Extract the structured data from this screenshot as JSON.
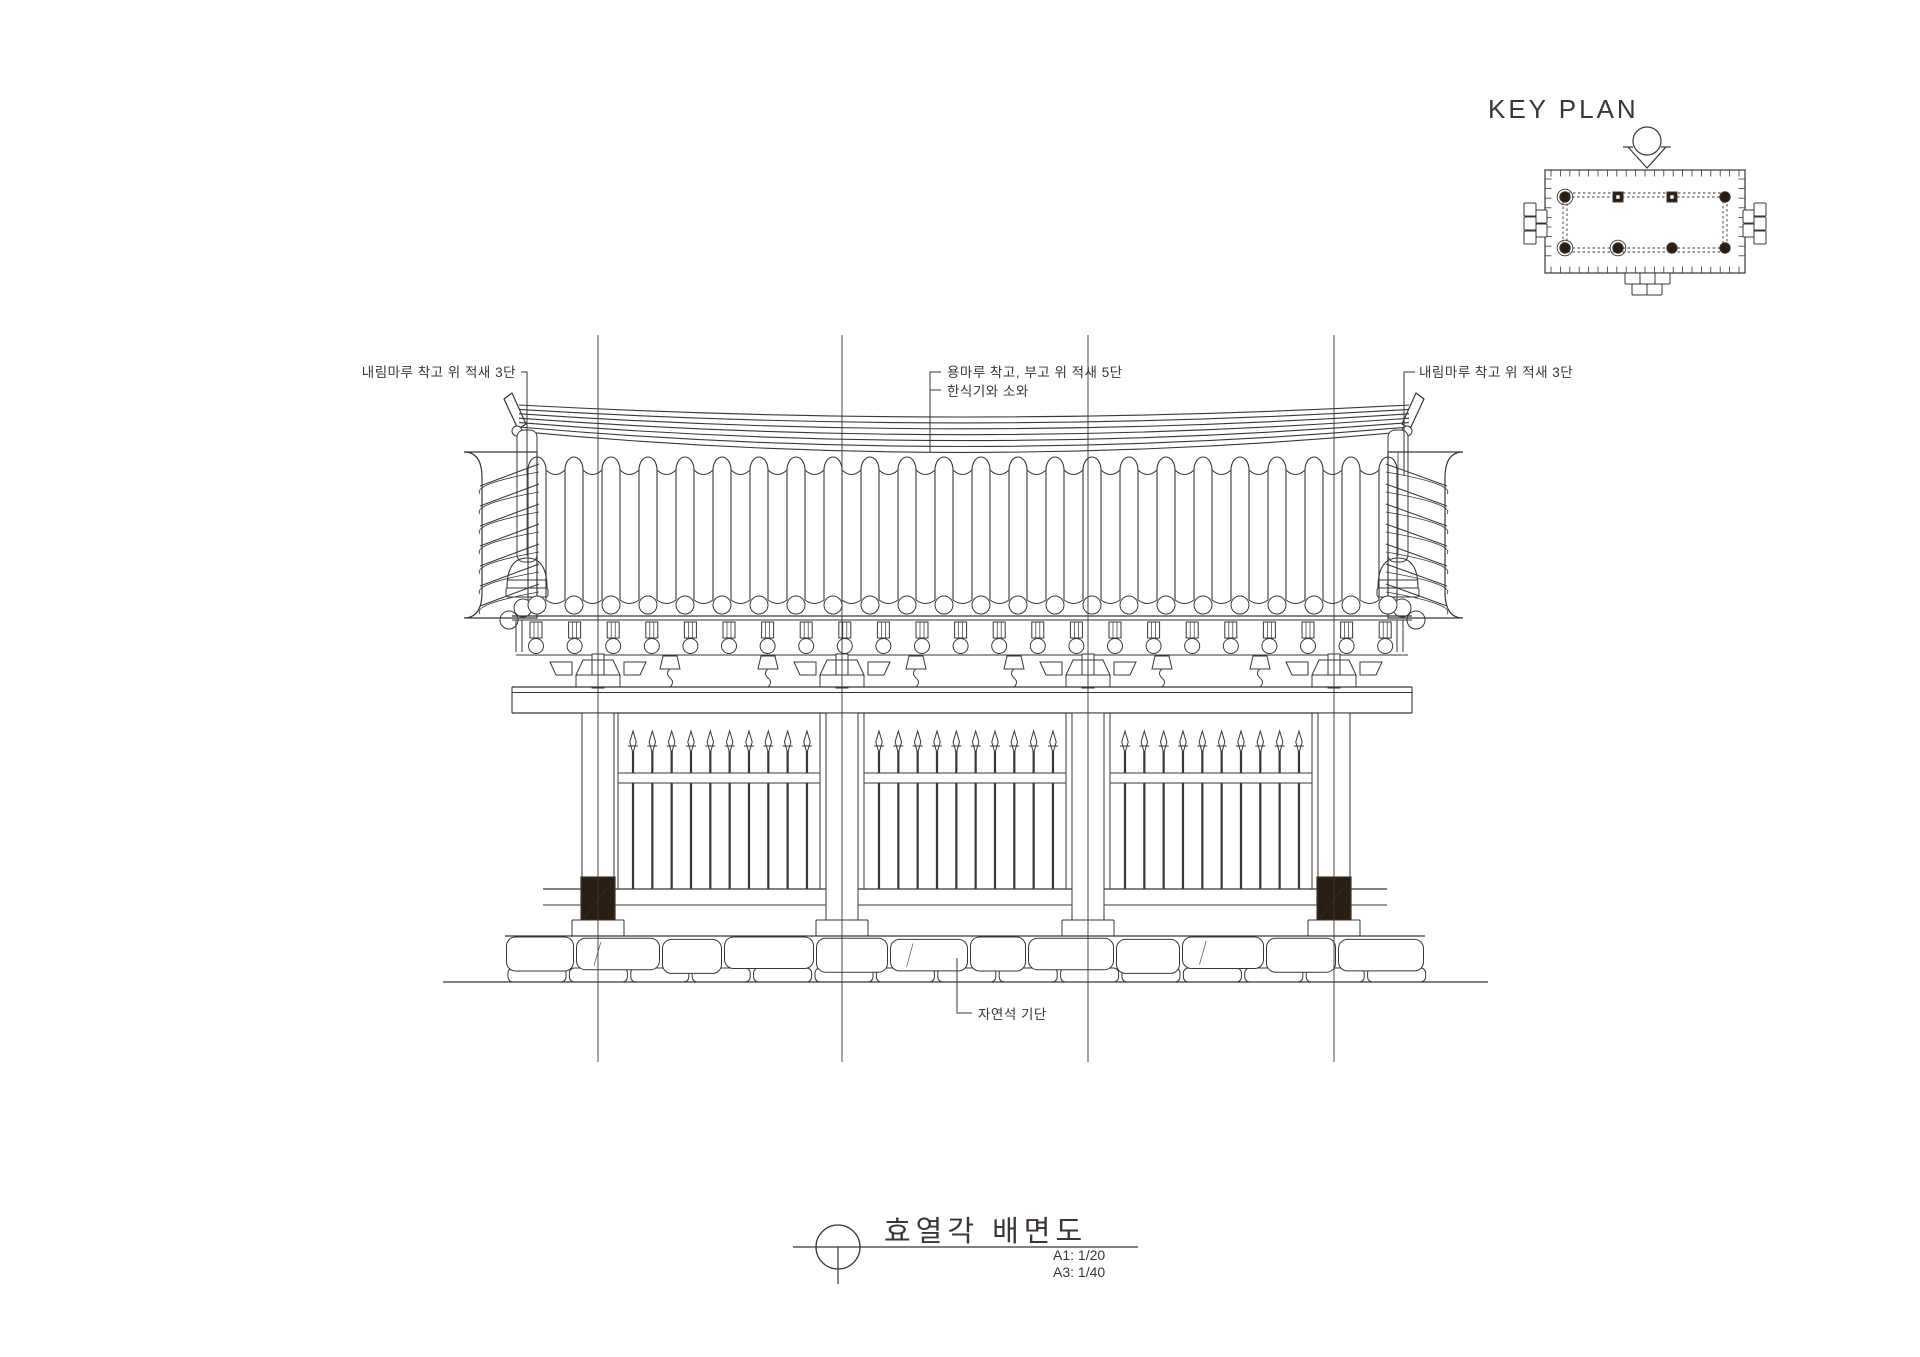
{
  "key_plan": {
    "label": "KEY PLAN"
  },
  "annotations": {
    "left_ridge": "내림마루 착고 위 적새 3단",
    "main_ridge": "용마루 착고, 부고 위 적새 5단",
    "roof_tiles": "한식기와 소와",
    "right_ridge": "내림마루 착고 위 적새 3단",
    "stylobate": "자연석 기단"
  },
  "title_block": {
    "title": "효열각 배면도",
    "scale_a1": "A1: 1/20",
    "scale_a3": "A3: 1/40"
  },
  "colors": {
    "ink": "#3b3633",
    "plinth": "#2a1d12",
    "background": "#ffffff"
  }
}
